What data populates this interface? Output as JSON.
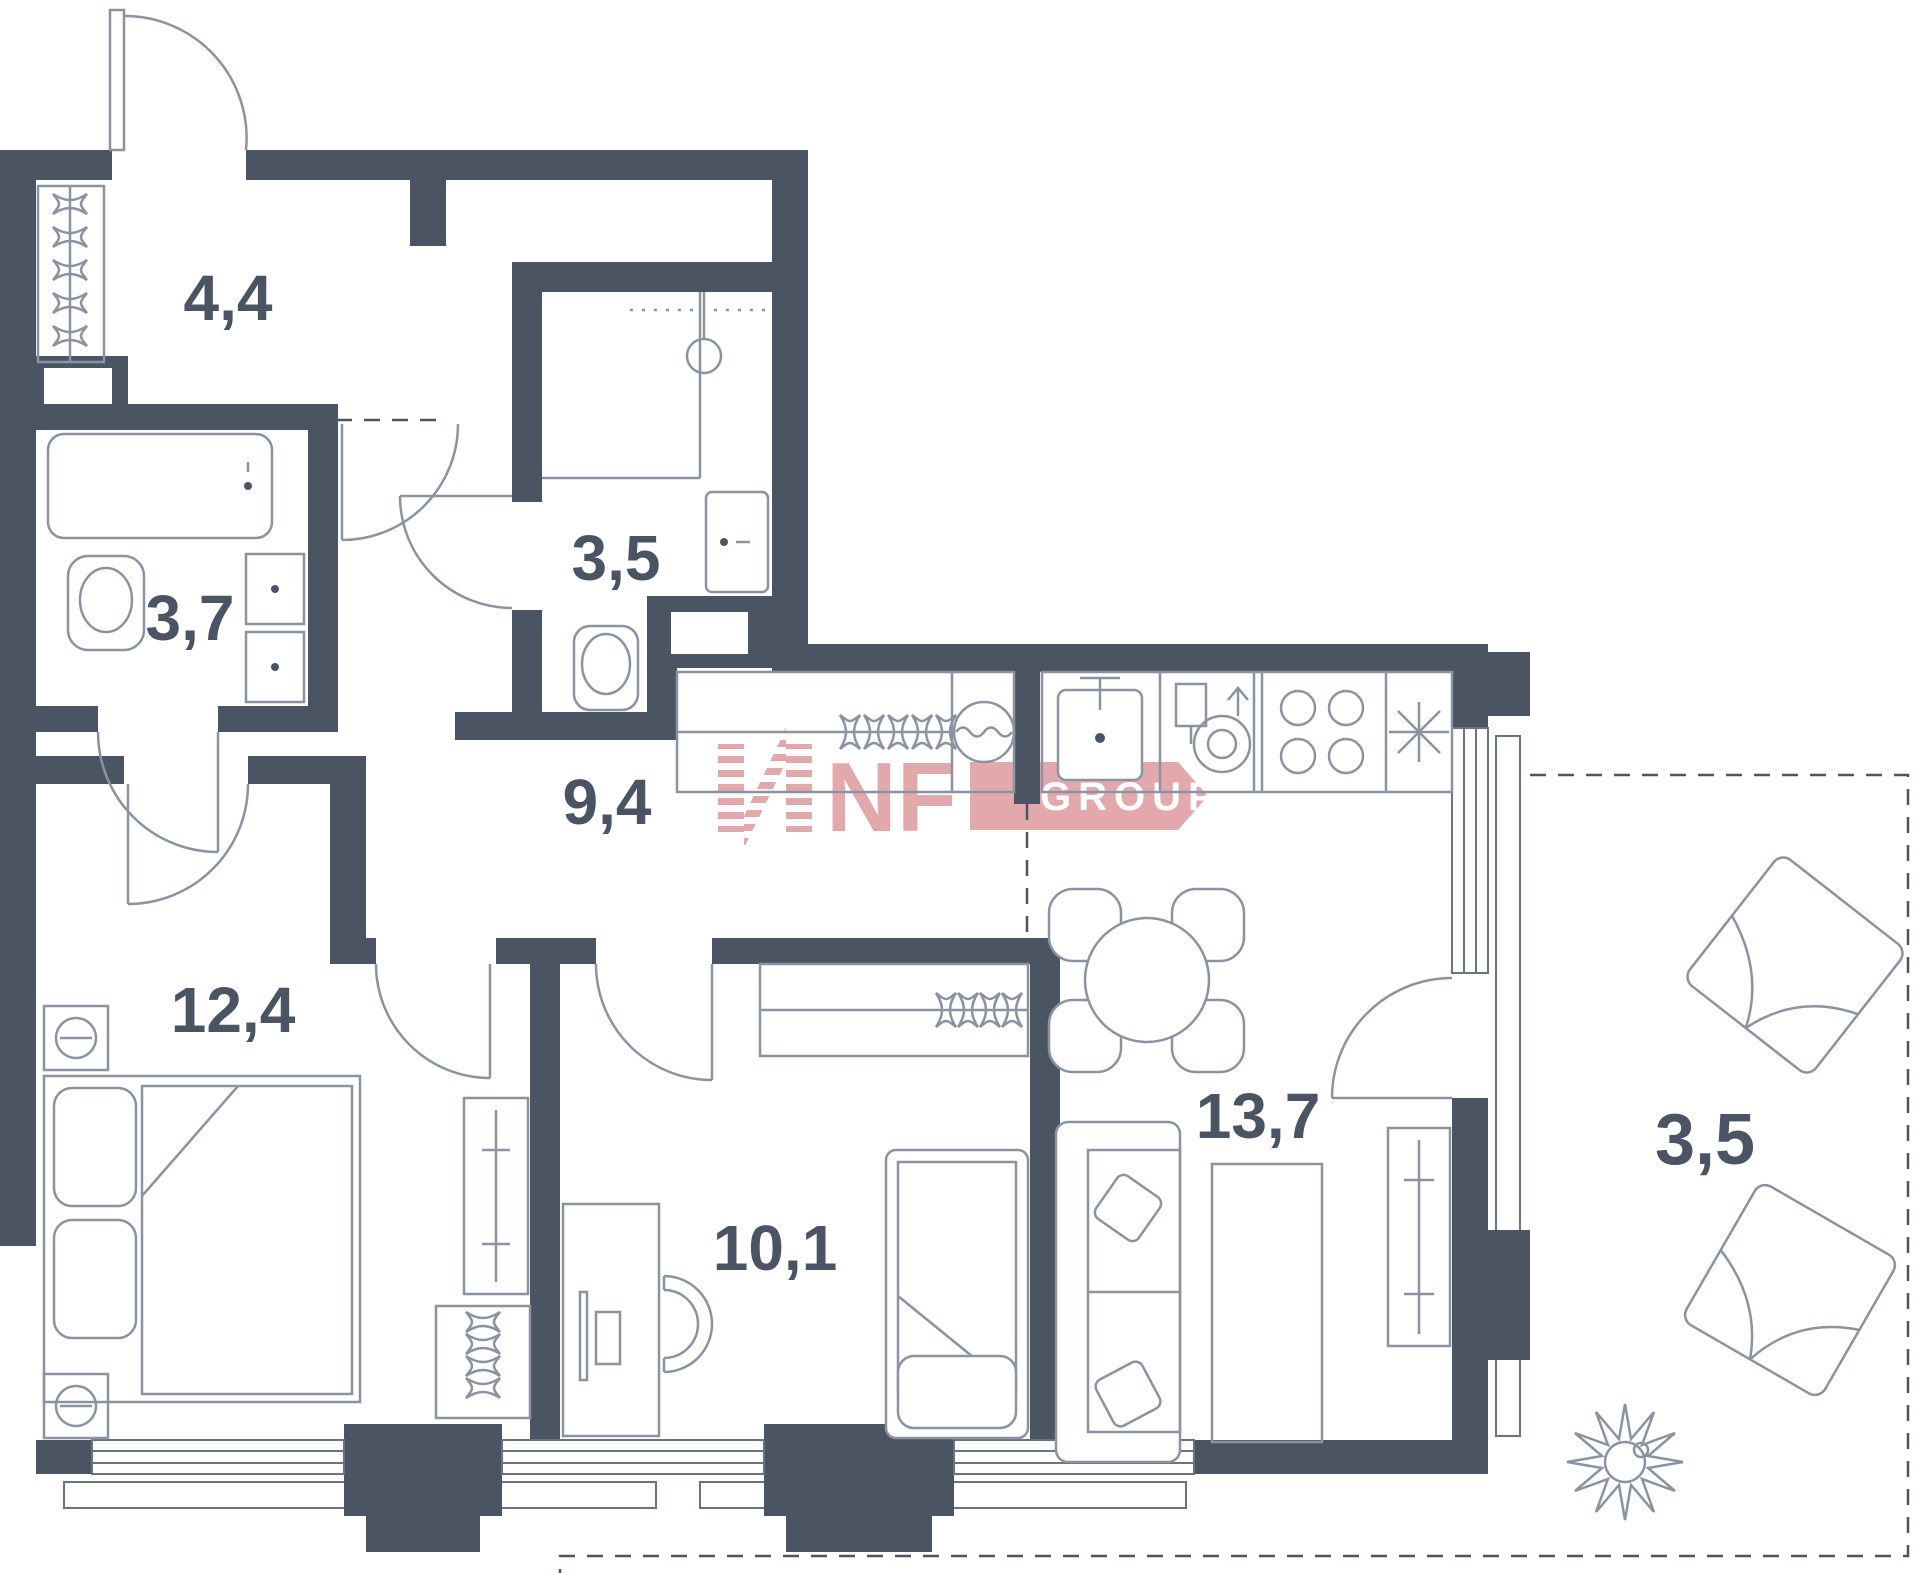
{
  "plan": {
    "type": "apartment-floor-plan",
    "rooms": [
      {
        "id": "hallway",
        "label": "4,4"
      },
      {
        "id": "shower-room",
        "label": "3,5"
      },
      {
        "id": "bathroom",
        "label": "3,7"
      },
      {
        "id": "corridor",
        "label": "9,4"
      },
      {
        "id": "bedroom",
        "label": "12,4"
      },
      {
        "id": "kids-room",
        "label": "10,1"
      },
      {
        "id": "living-kitchen",
        "label": "13,7"
      },
      {
        "id": "balcony",
        "label": "3,5"
      }
    ]
  },
  "watermark": {
    "nf": "NF",
    "group": "GROUP"
  },
  "colors": {
    "wall": "#4A5462",
    "furniture_line": "#8B93A1",
    "logo_pink": "#E2A9AD",
    "background": "#FFFFFF"
  }
}
